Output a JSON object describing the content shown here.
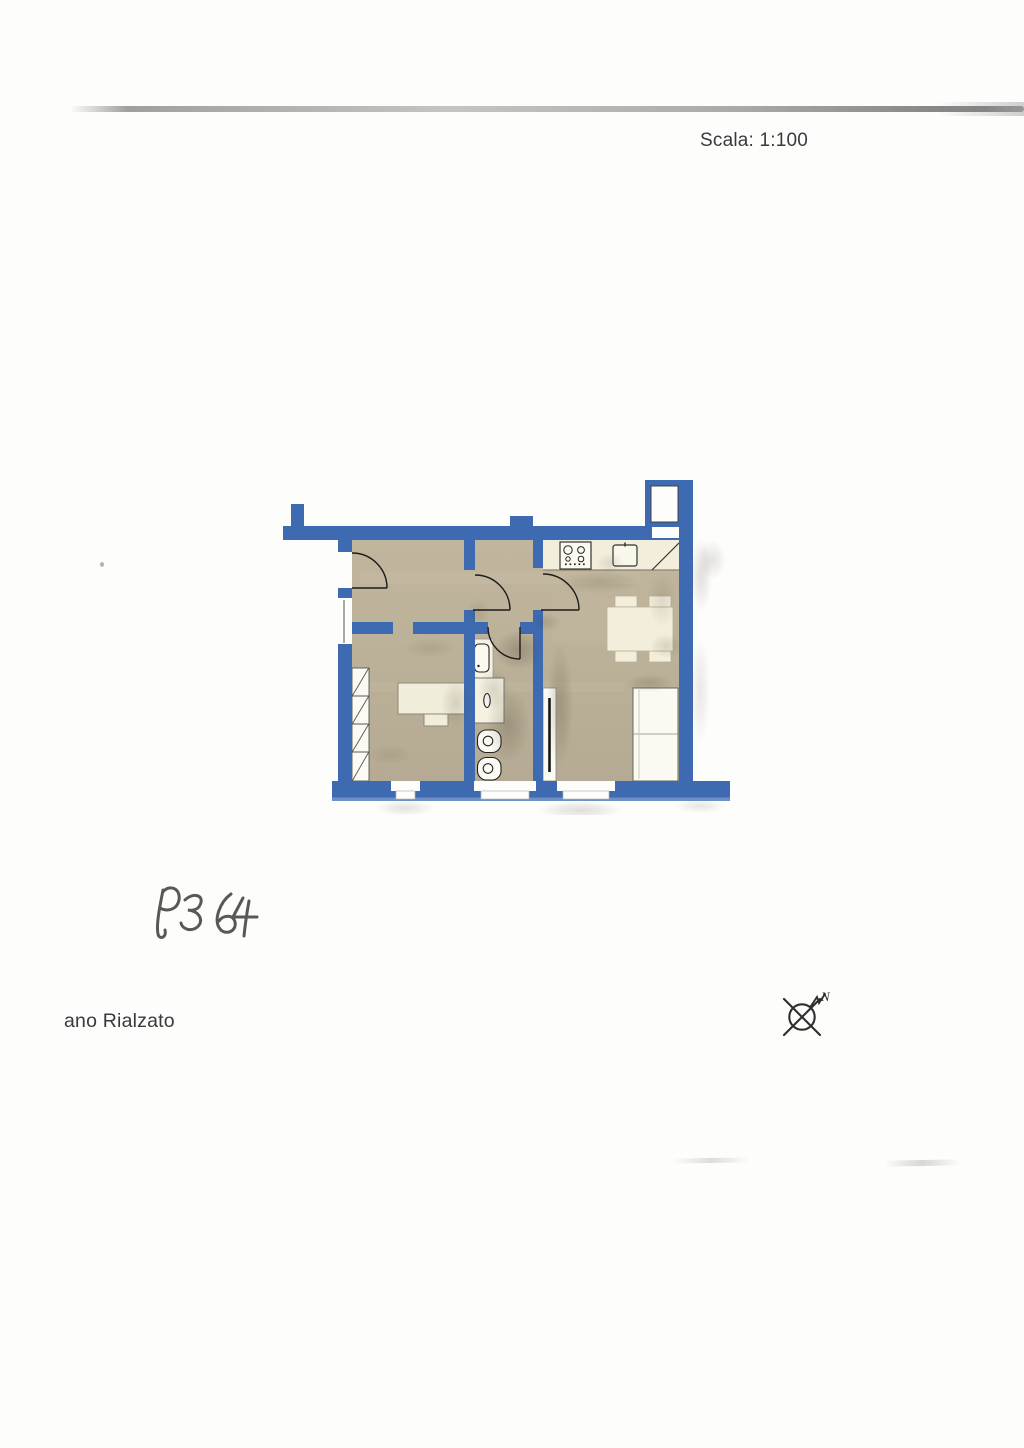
{
  "document": {
    "scale_label": "Scala: 1:100",
    "floor_label": "ano Rialzato",
    "handwritten_code": "P364",
    "compass": {
      "north_label": "N"
    }
  },
  "colors": {
    "wall_blue": "#3e6ab1",
    "wall_blue_light_edge": "#6e90c4",
    "floor_tan": "#bcb19a",
    "furniture_cream": "#f2eedb",
    "fixture_white": "#fcfaf0",
    "text_gray": "#3a3a3e"
  },
  "plan": {
    "type": "apartment-floor-plan",
    "scale": "1:100",
    "fixtures_depicted": [
      "chimney-stub",
      "vent-shaft",
      "entrance-door",
      "hall-door",
      "kitchen-door",
      "bathroom-door",
      "left-wall-window",
      "bedroom-window",
      "bathroom-window",
      "living-room-window",
      "wardrobe",
      "desk",
      "desk-chair",
      "washbasin",
      "shower-tray",
      "toilet",
      "bidet",
      "kitchen-counter",
      "cooktop",
      "kitchen-sink",
      "corner-cabinet",
      "dining-table",
      "dining-chairs",
      "sofa",
      "radiator-panel"
    ]
  }
}
